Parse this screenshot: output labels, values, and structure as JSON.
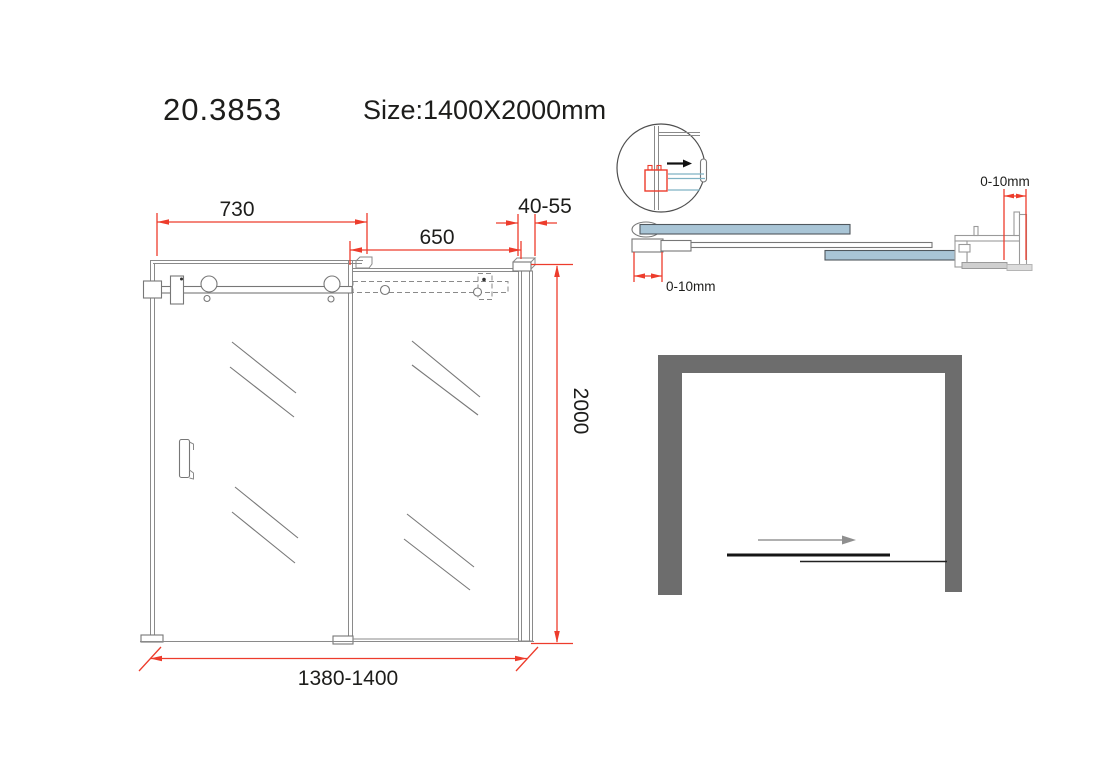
{
  "header": {
    "model_number": "20.3853",
    "size_label": "Size:1400X2000mm"
  },
  "front_view": {
    "dim_slide_panel_width": "730",
    "dim_fixed_panel_width": "650",
    "dim_wall_profile_range": "40-55",
    "dim_height": "2000",
    "dim_overall_width": "1380-1400"
  },
  "section_view": {
    "dim_door_adjust": "0-10mm",
    "dim_wall_adjust": "0-10mm"
  },
  "colors": {
    "dimension_red": "#ed3c2c",
    "glass_blue": "#a9c5d6",
    "wall_gray": "#6d6d6d",
    "drawing_gray": "#8a8a8a"
  }
}
